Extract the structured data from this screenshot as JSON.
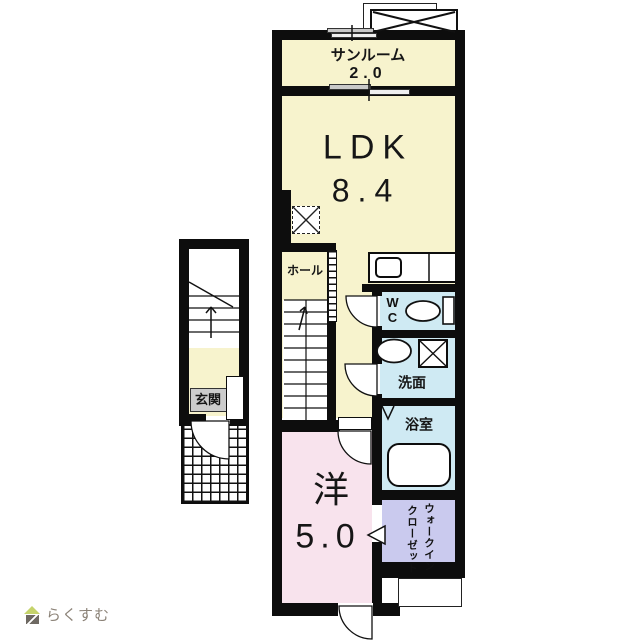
{
  "plan": {
    "type": "floor-plan",
    "colors": {
      "floor_cream": "#f7f3cd",
      "floor_pink": "#f8e3ed",
      "floor_blue": "#cfeaf3",
      "floor_lavender": "#cacaee",
      "wall": "#0d0d0d",
      "entrance_label_bg": "#cccccc"
    },
    "rooms": {
      "sunroom": {
        "label": "サンルーム",
        "size": "2.0"
      },
      "ldk": {
        "label": "LDK",
        "size": "8.4"
      },
      "hall": {
        "label": "ホール"
      },
      "wc": {
        "label": "WC"
      },
      "washroom": {
        "label": "洗面"
      },
      "bathroom": {
        "label": "浴室"
      },
      "western_room": {
        "label": "洋",
        "size": "5.0"
      },
      "walk_in_closet": {
        "line1": "ウォークイン",
        "line2": "クローゼット"
      },
      "entrance": {
        "label": "玄関"
      }
    }
  },
  "footer": {
    "logo_text": "らくすむ",
    "logo_colors": {
      "roof_green": "#c5d36b",
      "body_grey": "#6e6962",
      "text_grey": "#8b8277"
    }
  }
}
